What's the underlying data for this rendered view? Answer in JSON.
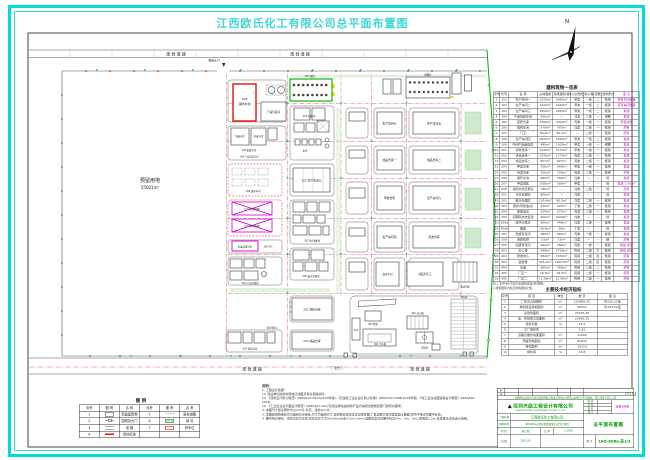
{
  "page": {
    "title": "江西欧氏化工有限公司总平面布置图"
  },
  "colors": {
    "sheet_border": "#00dcdc",
    "title_text": "#3fd6d6",
    "highlight_red": "#e01010",
    "boundary_green": "#00a800",
    "reserved_magenta": "#cc00cc",
    "titleblock_green": "#009b00",
    "annotation_cyan": "#00c6c6"
  },
  "north": {
    "label": "N"
  },
  "plan": {
    "labels": {
      "road_top": "规 划 道 路",
      "gate_top": "预留大门",
      "road_bottom": "规 划 道 路",
      "gate_bottom": "厂区大门",
      "reserve1": "预留用地",
      "reserve2": "55601m²",
      "b208_code": "208",
      "b208_name": "消防水池",
      "pack": "产品包装间",
      "tank207": "207 罐区",
      "boiler": "303 锅炉房",
      "pump": "泵房",
      "hw1": "危废仓库",
      "hw2": "危废仓库",
      "c105": "105 配套仓库",
      "c104": "104 产品包装车间",
      "w103": "103 生产车间三",
      "resv1": "生产车间(预留)",
      "resv2": "生产车间(预留)",
      "hwstore": "危废品暂存区",
      "hwcode": "306 307",
      "sewage": "301 污水处理站",
      "rain": "305 雨水收集池",
      "waste": "302 废水处理站",
      "w106": "106 维修车间",
      "r201": "201 原料仓库",
      "r202": "202 成品仓库",
      "r203": "203 成品仓库",
      "outlet": "雨水排放口",
      "tankfarm2": "储罐区",
      "pw7": "生产车间七",
      "pw5": "生产车间五",
      "fp1": "成品仓库一",
      "fp2": "成品仓库二",
      "raw1": "甲类仓库",
      "pw6": "生产车间六",
      "pw4": "生产车间四",
      "store5": "丙类仓库",
      "wh_a": "维修车间",
      "wh_b": "成品仓库三",
      "shed": "电动车棚",
      "office": "401 办公楼",
      "dorm": "402",
      "canteen": "403 食堂",
      "weigh": "404 汽车衡",
      "court": "篮球场",
      "parking": "停车场"
    }
  },
  "tables": {
    "buildings": {
      "title": "建构筑物一览表",
      "head": [
        "序号",
        "代号",
        "名  称",
        "占地面积",
        "建筑面积/容积",
        "火灾危险性",
        "耐火等级",
        "层数",
        "结构形式",
        "备 注"
      ],
      "rows": [
        [
          "1",
          "101",
          "生产车间一",
          "1220m²",
          "2440m²",
          "甲类",
          "一级",
          "二",
          "框架",
          "原有车间改造"
        ],
        [
          "2",
          "102",
          "生产车间二",
          "1220m²",
          "2440m²",
          "甲类",
          "一级",
          "二",
          "框架",
          "原有车间改造"
        ],
        [
          "3",
          "103",
          "生产车间三",
          "1850m²",
          "2930m²",
          "甲类",
          "一级",
          "二",
          "框架",
          "拟建"
        ],
        [
          "4",
          "104",
          "产品包装车间",
          "450m²",
          "—",
          "戊类",
          "二级",
          "一",
          "钢棚",
          "拟建"
        ],
        [
          "5",
          "105",
          "配套仓库",
          "2300m²",
          "2300m²",
          "丙类",
          "一级",
          "一",
          "框架",
          "原有改造"
        ],
        [
          "6",
          "106",
          "维修车间",
          "970m²",
          "970m²",
          "戊类",
          "二级",
          "一",
          "框架",
          "原有"
        ],
        [
          "7",
          "107",
          "门卫",
          "82.4m²",
          "82.4m²",
          "—",
          "二级",
          "一",
          "框架",
          "原有"
        ],
        [
          "8",
          "108",
          "生产车间四",
          "1870m²",
          "2560m²",
          "甲类",
          "一级",
          "二",
          "框架",
          "拟建"
        ],
        [
          "9",
          "109",
          "中间产品储存区",
          "480m²",
          "1000m³",
          "甲类",
          "一级",
          "一",
          "钢棚",
          "拟建"
        ],
        [
          "10",
          "201",
          "原料仓库一",
          "1240m²",
          "1170m²",
          "甲类",
          "一级",
          "一",
          "框架",
          "拟建"
        ],
        [
          "11",
          "202",
          "成品仓库一",
          "1240m²",
          "1170m²",
          "丙类",
          "二级",
          "一",
          "框架",
          "拟建"
        ],
        [
          "12",
          "203",
          "成品仓库二",
          "827m²",
          "827m²",
          "丙类",
          "二级",
          "一",
          "框架",
          "拟建"
        ],
        [
          "13",
          "204",
          "甲类仓库",
          "700m²",
          "546m²",
          "甲类",
          "一级",
          "一",
          "框架",
          "拟建"
        ],
        [
          "14",
          "205",
          "丙类仓库",
          "700m²",
          "700m²",
          "丙类",
          "二级",
          "一",
          "框架",
          "原有"
        ],
        [
          "15",
          "206",
          "循环水池",
          "480m²",
          "350m³",
          "戊类",
          "—",
          "—",
          "砼",
          "拟建"
        ],
        [
          "16",
          "207",
          "甲类罐区",
          "1080m²",
          "500m³",
          "甲类",
          "—",
          "—",
          "砼",
          "拟建 1-50m³"
        ],
        [
          "17",
          "208",
          "消防水池及泵房",
          "780m²",
          "—",
          "戊类",
          "二级",
          "一",
          "砼",
          "原有"
        ],
        [
          "18",
          "301",
          "污水处理站",
          "800m²",
          "—",
          "戊类",
          "—",
          "—",
          "砼",
          "拟建"
        ],
        [
          "19",
          "302",
          "废水处理区",
          "105.4m²",
          "80.5m²",
          "戊类",
          "二级",
          "一",
          "框架",
          "拟建"
        ],
        [
          "20",
          "303",
          "锅炉(导热油)房",
          "270m²",
          "220m²",
          "丁类",
          "二级",
          "一",
          "框架",
          "拟建"
        ],
        [
          "21",
          "304",
          "变配电房",
          "254m²",
          "270m²",
          "丙类",
          "二级",
          "一",
          "框架",
          "拟建"
        ],
        [
          "22",
          "305",
          "初期雨水收集池",
          "400m²",
          "2400m³",
          "戊类",
          "—",
          "—",
          "砼",
          "拟建"
        ],
        [
          "23",
          "306a",
          "循环水泵房",
          "560m²",
          "440m²",
          "戊类",
          "二级",
          "一",
          "框架",
          "拟建"
        ],
        [
          "24",
          "306b",
          "烟囱",
          "36.4m²",
          "28m",
          "丁类",
          "—",
          "—",
          "砼",
          "拟建"
        ],
        [
          "25",
          "307",
          "危废暂存间",
          "280m²",
          "280m²",
          "丙类",
          "一级",
          "一",
          "框架",
          "拟建"
        ],
        [
          "26",
          "308",
          "连廊栈桥",
          "53m²",
          "16m²",
          "戊类",
          "—",
          "—",
          "钢",
          "原有"
        ],
        [
          "27",
          "309",
          "固废暂存间",
          "262m²",
          "280m²",
          "丙类",
          "一级",
          "一",
          "框架",
          "拟建,暂定"
        ],
        [
          "28",
          "401",
          "办公楼",
          "498m²",
          "2796m²",
          "民用",
          "二级",
          "六",
          "框架",
          "原有,改造"
        ],
        [
          "29",
          "402",
          "研发中心",
          "384m²",
          "1530m²",
          "民用",
          "二级",
          "四",
          "框架",
          "原有"
        ],
        [
          "30",
          "403",
          "宿舍楼",
          "325.4m²",
          "1305.6m²",
          "民用",
          "二级",
          "四",
          "框架",
          "原有"
        ],
        [
          "31",
          "404",
          "食堂",
          "380m²",
          "760m²",
          "民用",
          "二级",
          "二",
          "框架",
          "原有"
        ],
        [
          "32",
          "405",
          "门卫一",
          "18.3m²",
          "18.3m²",
          "民用",
          "二级",
          "一",
          "框架",
          "原有"
        ],
        [
          "33",
          "406",
          "门卫二",
          "12.96m²",
          "12.96m²",
          "民用",
          "二级",
          "一",
          "框架",
          "原有"
        ]
      ],
      "notes": [
        "注:1.表中带※号者为本期新建建(构)筑物。",
        "2.建筑面积为各层建筑面积之和。"
      ]
    },
    "indicators": {
      "title": "主要技术经济指标",
      "head": [
        "序号",
        "项  目",
        "单位",
        "数  值",
        "备 注"
      ],
      "rows": [
        [
          "1",
          "厂区总占地面积",
          "m²",
          "150806.45",
          "约226.21亩"
        ],
        [
          "2",
          "规划建设用地面积",
          "m²",
          "69012",
          "约103.52亩"
        ],
        [
          "3",
          "总建筑面积",
          "m²",
          "25236.46",
          ""
        ],
        [
          "4",
          "建、构筑物占地面积",
          "m²",
          "22696.26",
          ""
        ],
        [
          "5",
          "建筑系数",
          "%",
          "42.5",
          ""
        ],
        [
          "6",
          "工厂容积率",
          "",
          "0.81",
          ""
        ],
        [
          "7",
          "道路及硬化地面面积",
          "m²",
          "11900",
          ""
        ],
        [
          "8",
          "预留用地面积",
          "m²",
          "81604",
          ""
        ],
        [
          "9",
          "绿化面积",
          "m²",
          "10210",
          ""
        ],
        [
          "10",
          "绿化率",
          "%",
          "18.8",
          ""
        ]
      ]
    }
  },
  "legend": {
    "title": "图  例",
    "col_no": "序号",
    "col_sym": "图 例",
    "col_name": "名  称",
    "items": [
      {
        "no": "1",
        "name": "新建建筑物"
      },
      {
        "no": "2",
        "name": "围墙及大门"
      },
      {
        "no": "3",
        "name": "道  路"
      },
      {
        "no": "4",
        "name": "用地红线"
      },
      {
        "no": "5",
        "name": "原有道路"
      },
      {
        "no": "6",
        "name": "绿  化"
      },
      {
        "no": "7",
        "name": "停车位"
      }
    ]
  },
  "notes": {
    "title": "说明:",
    "lines": [
      "1. 工程设计依据:",
      "(1) 建设单位提供的用地红线图及有关基础资料。",
      "(2) 《建筑设计防火规范》GB50016-2014(2018年版),《石油化工企业设计防火标准》GB50160-2008(2018年版),《化工企业总图运输设计规范》GB50489-2009。",
      "(3) 《工业企业总平面设计规范》GB50187-2012及建设单位提供的产品方案和当地规划部门的有关要求。",
      "2. 本图尺寸除注明外均以mm计,标高、坐标以m计。",
      "3. 本图建筑物坐标均为轴线交点坐标,尺寸为轴线尺寸,建筑物具体定位详见单体图;厂区道路为城市型混凝土路面,转弯半径详见图中标注。",
      "4. 图中所示绿化、停车位仅为示意,停车位尺寸为3m×6m(大车3.5m×10m),道路宽度详见图中标注(4m、6m、8m),围墙高2.2m,具体做法详见设计说明。"
    ]
  },
  "titleblock": {
    "rev_mark": "▲",
    "rev_date": "2021.6",
    "confidential": "该图纸及其设计内容归深圳天励工程设计有限公司所有,未经许可不得复制、转让或用于其它工程",
    "logo_glyph": "▲",
    "company": "深圳天励工程设计有限公司",
    "company_sub": "SHENZHEN TIANLI ENGINEERING DESIGN CO.,LTD.",
    "f_shending": "审 定",
    "f_shenhe": "审 核",
    "f_jiaodui": "校 对",
    "f_sheji": "设 计",
    "stamp": "出图专用章",
    "project_label": "工程名称",
    "project": "江西欧氏化工有限公司",
    "item_label": "项目名称",
    "item": "40000t/a水性树脂及配套产品生产项目",
    "stage_label": "阶 段",
    "stage": "施工图",
    "scale_label": "比 例",
    "scale": "1:1000",
    "date_label": "日 期",
    "date": "2021.06",
    "drawing": "总平面布置图",
    "no_label": "图 号",
    "no": "18Q-806a-总1/3"
  }
}
